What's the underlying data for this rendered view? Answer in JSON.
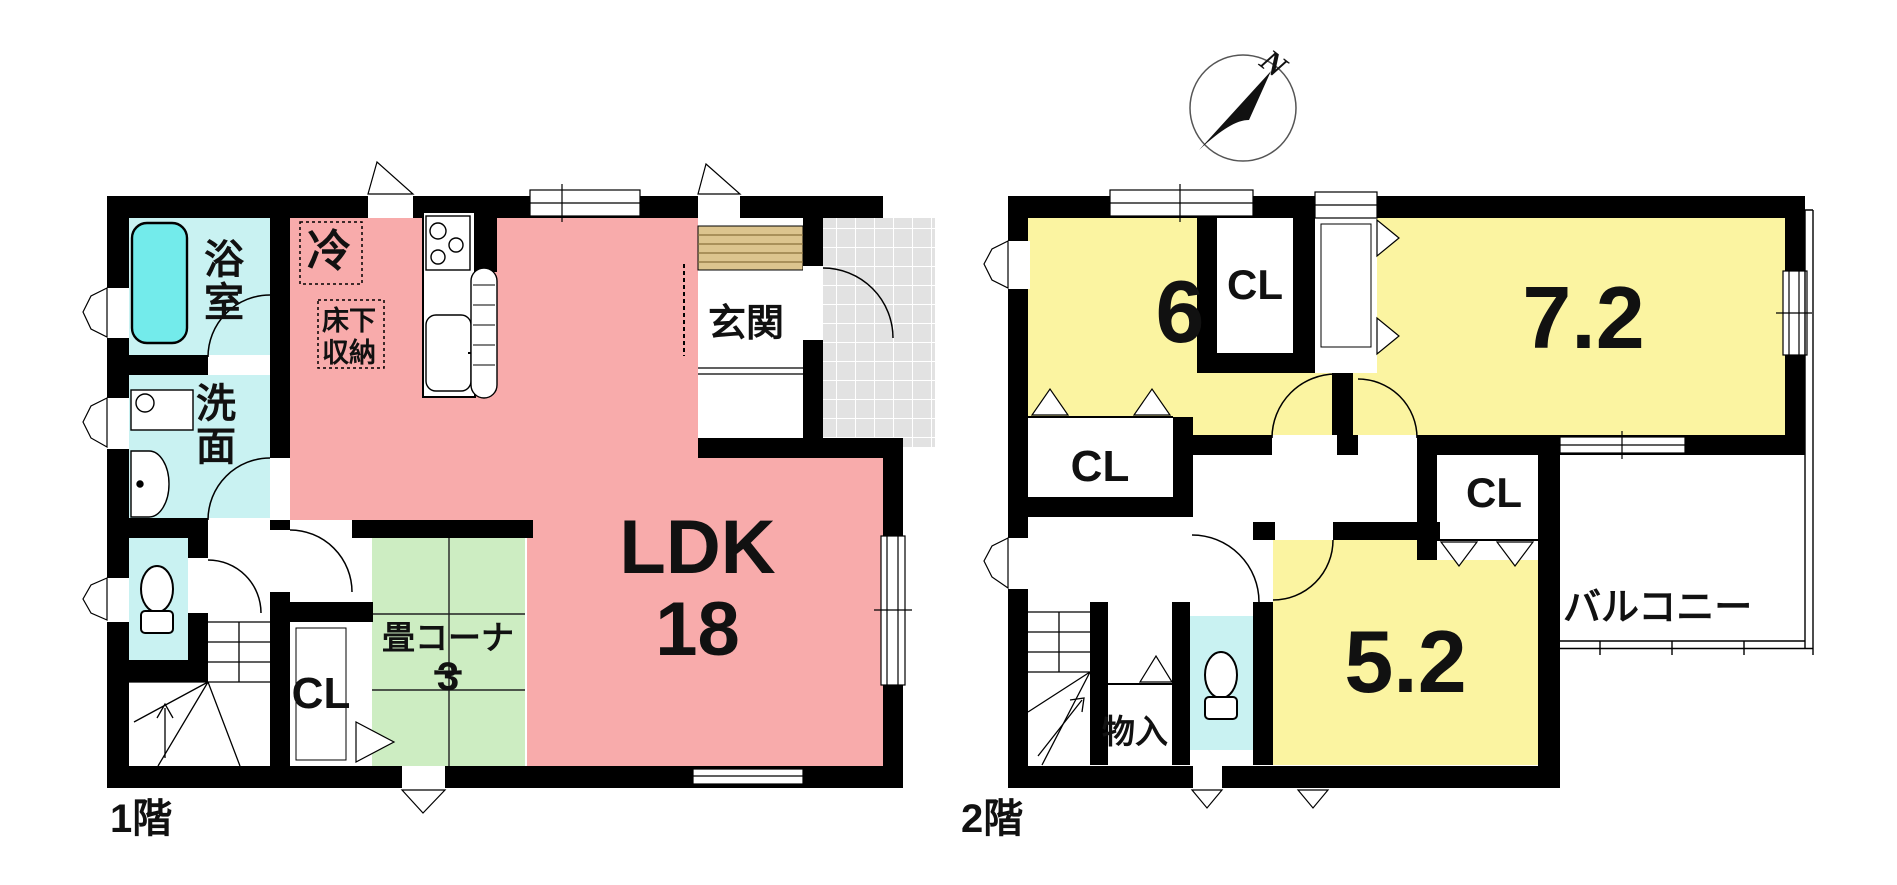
{
  "colors": {
    "wall": "#000000",
    "ldk": "#f8abab",
    "bedroom": "#fbf4a1",
    "tatami": "#cdedc2",
    "water": "#c9f2f2",
    "bathtub": "#73ebeb",
    "entrance_step": "#dcc48e",
    "porch_tile": "#e2e2e2"
  },
  "floor1": {
    "caption": "1階",
    "rooms": {
      "bath": "浴室",
      "washroom": "洗面",
      "refrigerator": "冷",
      "underfloor_storage": "床下収納",
      "entrance": "玄関",
      "ldk_label": "LDK",
      "ldk_size": "18",
      "tatami_label": "畳コーナー",
      "tatami_size": "3",
      "closet": "CL"
    }
  },
  "floor2": {
    "caption": "2階",
    "rooms": {
      "room6_size": "6",
      "room72_size": "7.2",
      "room52_size": "5.2",
      "closet_a": "CL",
      "closet_b": "CL",
      "closet_c": "CL",
      "storage": "物入",
      "balcony": "バルコニー"
    }
  },
  "compass": {
    "north": "N"
  }
}
